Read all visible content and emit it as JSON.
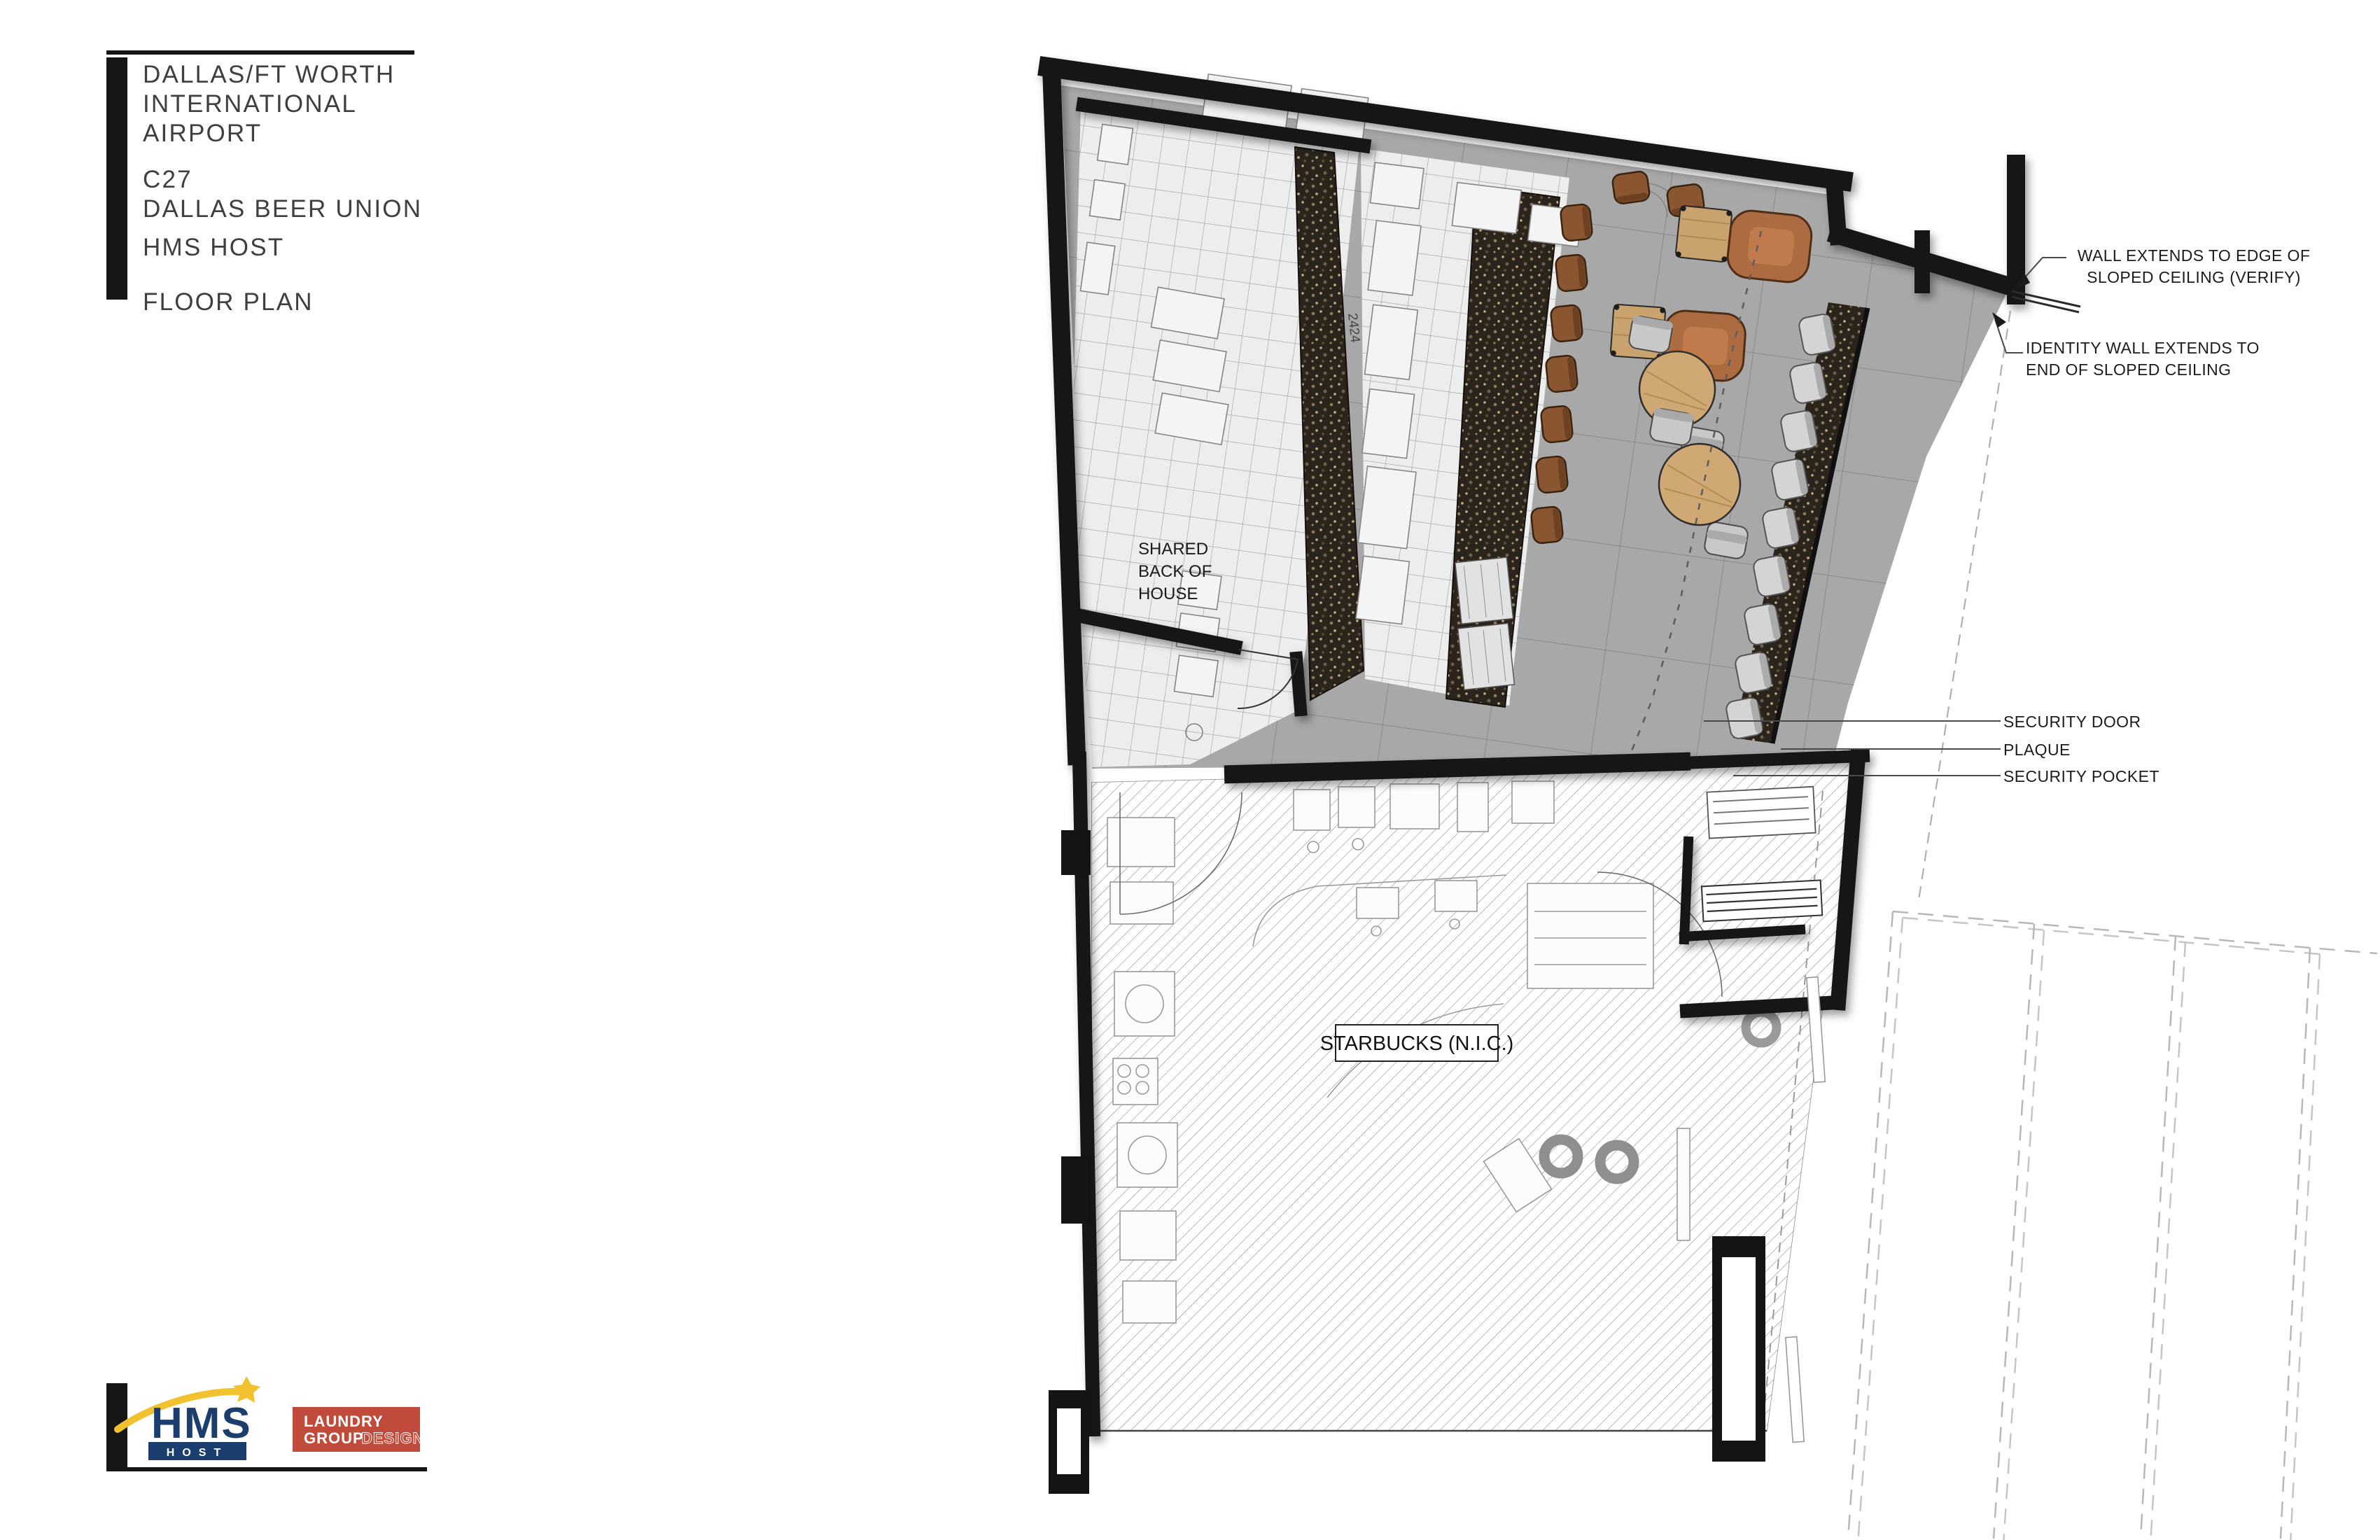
{
  "title_block": {
    "project": [
      "DALLAS/FT WORTH",
      "INTERNATIONAL",
      "AIRPORT"
    ],
    "unit": "C27",
    "concept": "DALLAS BEER UNION",
    "operator": "HMS HOST",
    "sheet_title": "FLOOR PLAN"
  },
  "plan_labels": {
    "shared_boh": [
      "SHARED",
      "BACK OF",
      "HOUSE"
    ],
    "starbucks": "STARBUCKS (N.I.C.)",
    "equipment_tag": "2424"
  },
  "annotations": {
    "wall_extends": {
      "line1": "WALL EXTENDS TO EDGE OF",
      "line2": "SLOPED CEILING (VERIFY)"
    },
    "identity_wall": {
      "line1": "IDENTITY WALL EXTENDS TO",
      "line2": "END OF SLOPED CEILING"
    },
    "security_door": "SECURITY DOOR",
    "plaque": "PLAQUE",
    "security_pocket": "SECURITY POCKET"
  },
  "logos": {
    "hms_host": {
      "word": "HMS",
      "sub": "HOST"
    },
    "laundry_group": {
      "line1": "LAUNDRY",
      "line2": "GROUP",
      "line3": "DESIGN"
    }
  },
  "colors": {
    "wall_black": "#141414",
    "floor_concrete": "#a8a8a8",
    "floor_tile": "#ededed",
    "mosaic_dark": "#2b241d",
    "wood_stool": "#8a5632",
    "copper_lounge": "#ad6b42",
    "wood_table": "#c9a26e",
    "hms_navy": "#1c3e6e",
    "hms_yellow": "#f2c12e",
    "laundry_red": "#c14b3a"
  }
}
